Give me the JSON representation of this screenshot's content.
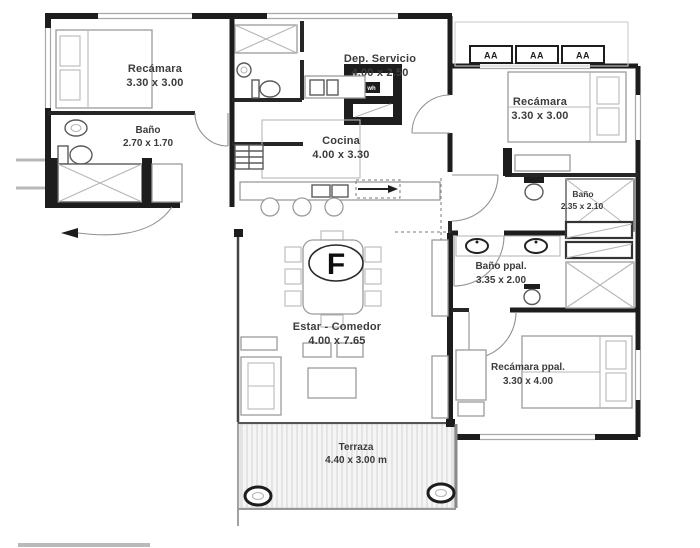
{
  "title": "Planta arquitectonica - floor plan",
  "colors": {
    "background": "#ffffff",
    "wall": "#1d1d1d",
    "furniture_line": "#9c9c9c",
    "fixture_line": "#5a5a5a",
    "label_text": "#3c3c3c",
    "terrace_hatch": "#d9d9d9"
  },
  "rooms": [
    {
      "id": "recamara-tl",
      "name": "Recámara",
      "dims": "3.30 x 3.00"
    },
    {
      "id": "bano-tl",
      "name": "Baño",
      "dims": "2.70 x 1.70"
    },
    {
      "id": "dep-servicio",
      "name": "Dep. Servicio",
      "dims": "4.00 x 2.50"
    },
    {
      "id": "cocina",
      "name": "Cocina",
      "dims": "4.00 x 3.30"
    },
    {
      "id": "recamara-tr",
      "name": "Recámara",
      "dims": "3.30 x 3.00"
    },
    {
      "id": "bano-r",
      "name": "Baño",
      "dims": "2.35 x 2.10"
    },
    {
      "id": "bano-ppal",
      "name": "Baño ppal.",
      "dims": "3.35 x 2.00"
    },
    {
      "id": "estar-comedor",
      "name": "Estar - Comedor",
      "dims": "4.00 x 7.65"
    },
    {
      "id": "recamara-ppal",
      "name": "Recámara ppal.",
      "dims": "3.30 x 4.00"
    },
    {
      "id": "terraza",
      "name": "Terraza",
      "dims": "4.40 x 3.00 m"
    }
  ],
  "markers": {
    "floor_label": "F",
    "heater_label": "wh",
    "ac_units": [
      "AA",
      "AA",
      "AA"
    ]
  }
}
